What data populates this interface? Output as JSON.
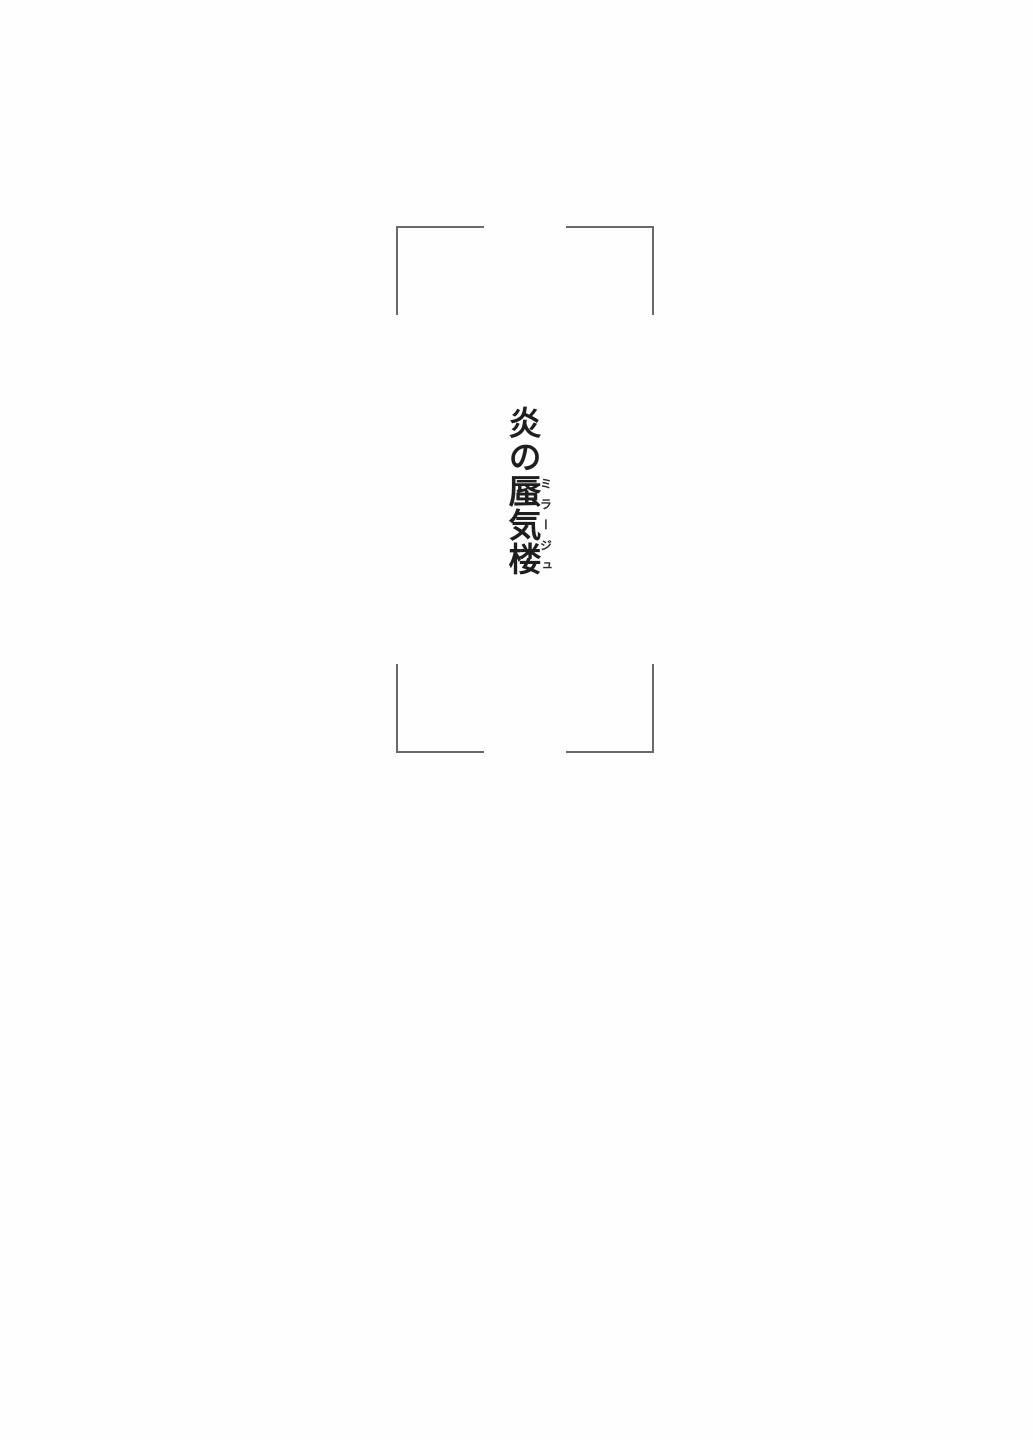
{
  "page": {
    "kind": "book-interior-title-page",
    "background_color": "#fefefe",
    "frame": {
      "style": "four corner brackets (crop-mark frame)",
      "line_color": "#6a6a6a"
    },
    "title": {
      "full": "炎の蜃気楼",
      "prefix": "炎の",
      "ruby_base": "蜃気楼",
      "furigana": "ミラージュ",
      "orientation": "vertical",
      "text_color": "#1e1e1e"
    }
  }
}
